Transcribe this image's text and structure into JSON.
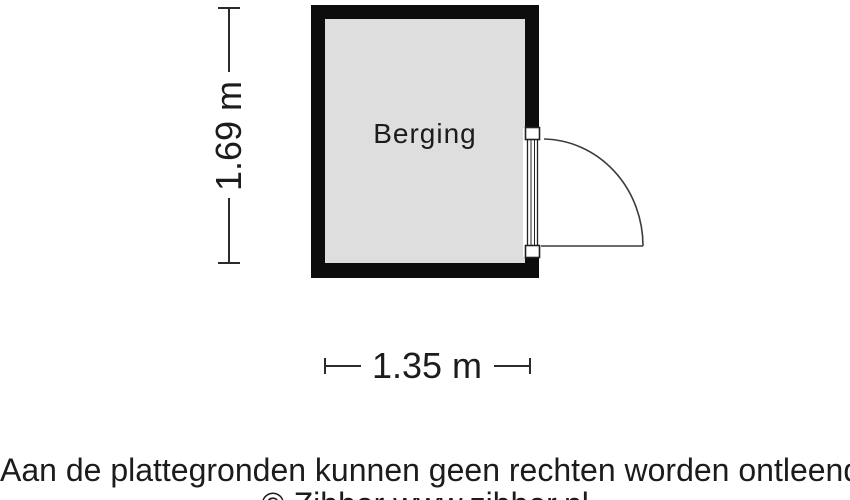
{
  "plan": {
    "room": {
      "label": "Berging",
      "width_label": "1.35 m",
      "height_label": "1.69 m",
      "width_m": 1.35,
      "height_m": 1.69
    }
  },
  "footer": {
    "disclaimer": "Aan de plattegronden kunnen geen rechten worden ontleend",
    "credit": "© Zibber www.zibber.nl"
  },
  "icons": {
    "door_swing": "quarter-circle-door-swing"
  },
  "colors": {
    "wall": "#0d0d0d",
    "floor": "#dedede",
    "dimension_line": "#2b2b2b",
    "door_line": "#3c3c3c",
    "text": "#1c1c1c",
    "background": "#ffffff"
  }
}
